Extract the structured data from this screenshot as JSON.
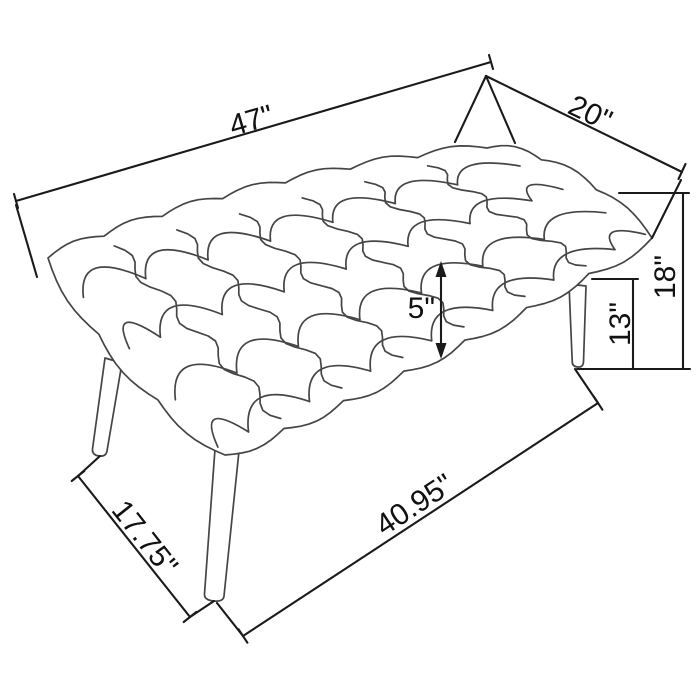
{
  "dimensions": {
    "top_length": {
      "label": "47\""
    },
    "top_depth": {
      "label": "20\""
    },
    "overall_height": {
      "label": "18\""
    },
    "leg_clearance": {
      "label": "13\""
    },
    "cushion_thickness": {
      "label": "5\""
    },
    "bottom_depth": {
      "label": "17.75\""
    },
    "bottom_length": {
      "label": "40.95\""
    }
  },
  "colors": {
    "sketch": "#454545",
    "dimension": "#1a1a1a",
    "text": "#111111",
    "background": "#ffffff"
  }
}
